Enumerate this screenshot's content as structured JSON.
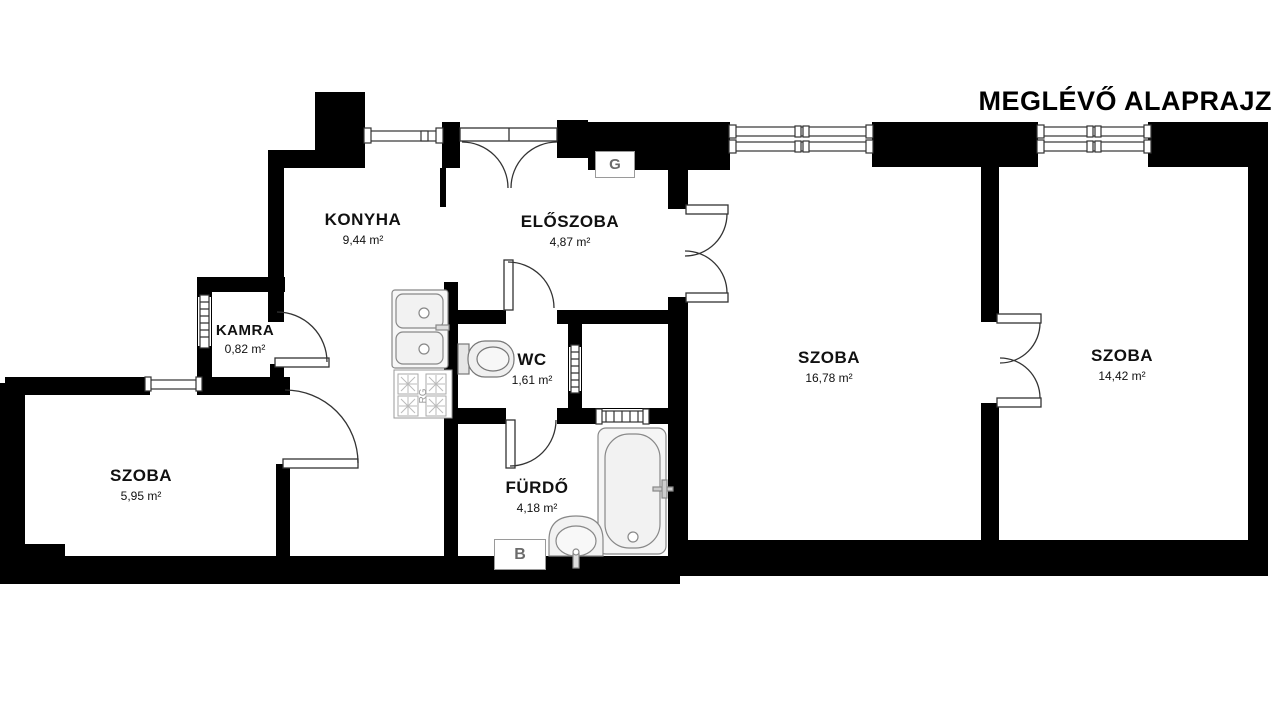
{
  "title": "MEGLÉVŐ ALAPRAJZ",
  "rooms": [
    {
      "id": "konyha",
      "name": "KONYHA",
      "area": "9,44 m²"
    },
    {
      "id": "eloszoba",
      "name": "ELŐSZOBA",
      "area": "4,87 m²"
    },
    {
      "id": "kamra",
      "name": "KAMRA",
      "area": "0,82 m²"
    },
    {
      "id": "wc",
      "name": "WC",
      "area": "1,61 m²"
    },
    {
      "id": "szoba-nagy",
      "name": "SZOBA",
      "area": "16,78 m²"
    },
    {
      "id": "szoba-jobb",
      "name": "SZOBA",
      "area": "14,42 m²"
    },
    {
      "id": "szoba-bal",
      "name": "SZOBA",
      "area": "5,95 m²"
    },
    {
      "id": "furdo",
      "name": "FÜRDŐ",
      "area": "4,18 m²"
    }
  ],
  "markers": {
    "gas_meter": "G",
    "boiler": "B",
    "stove": "RG"
  },
  "colors": {
    "wall": "#000000",
    "background": "#ffffff",
    "door_stroke": "#333333",
    "fixture_fill": "#f2f2f2",
    "fixture_stroke": "#888888",
    "marker_border": "#9a9a9a",
    "marker_text": "#6b6b6b",
    "label_text": "#111111"
  }
}
